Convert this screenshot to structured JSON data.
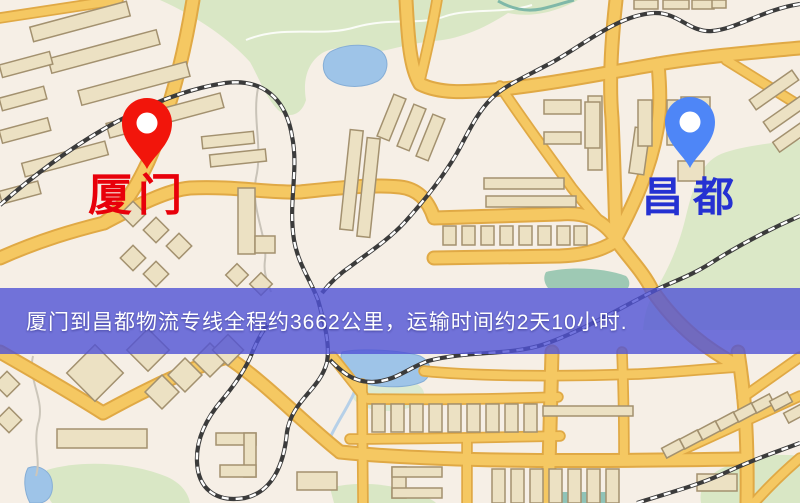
{
  "banner": {
    "text": "厦门到昌都物流专线全程约3662公里，运输时间约2天10小时.",
    "background_color": "#5052d6",
    "text_color": "#ffffff"
  },
  "origin": {
    "label": "厦门",
    "pin_color": "#f2150b",
    "label_color": "#e8000a"
  },
  "destination": {
    "label": "昌都",
    "pin_color": "#4e86f7",
    "label_color": "#2531d2"
  },
  "map_colors": {
    "background": "#f6efe6",
    "road_fill": "#f5c862",
    "road_casing": "#e0a945",
    "building_fill": "#ece1c3",
    "building_outline": "#a3916f",
    "park_green": "#d9e7c5",
    "water_blue": "#9ec4e8",
    "railway_dark": "#3b3b3b"
  }
}
